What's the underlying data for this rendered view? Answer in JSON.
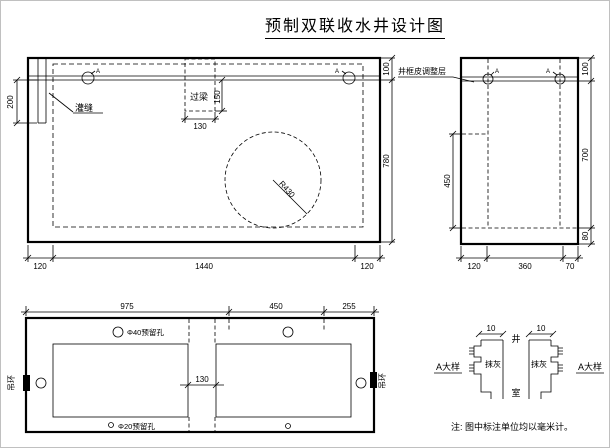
{
  "title": "预制双联收水井设计图",
  "front_view": {
    "marker_a_left": "A",
    "marker_a_right": "A",
    "label_grout_seam": "灌缝",
    "label_lintel": "过梁",
    "label_radius": "R430",
    "dim_lintel_h": "150",
    "dim_lintel_w": "130",
    "dim_seam_depth": "200",
    "dim_right_top": "100",
    "dim_right_main": "780",
    "dim_bottom_left": "120",
    "dim_bottom_mid": "1440",
    "dim_bottom_right": "120"
  },
  "side_view": {
    "label_adjust_layer": "井框皮调整层",
    "marker_a_left": "A",
    "marker_a_right": "A",
    "dim_left": "450",
    "dim_right_top": "100",
    "dim_right_mid": "700",
    "dim_right_bottom": "80",
    "dim_bottom_left": "120",
    "dim_bottom_mid": "360",
    "dim_bottom_right": "70"
  },
  "top_view": {
    "dim_top_left": "975",
    "dim_top_mid": "450",
    "dim_top_right": "255",
    "dim_center": "130",
    "label_hole_large": "Φ40预留孔",
    "label_hole_small": "Φ20预留孔",
    "label_ring_left": "吊环",
    "label_ring_right": "吊环"
  },
  "detail_view": {
    "dim_left": "10",
    "dim_right": "10",
    "label_well": "井",
    "label_chamber": "室",
    "label_plaster_left": "抹灰",
    "label_plaster_right": "抹灰",
    "title_left": "A大样",
    "title_right": "A大样"
  },
  "note": "注: 图中标注单位均以毫米计。"
}
